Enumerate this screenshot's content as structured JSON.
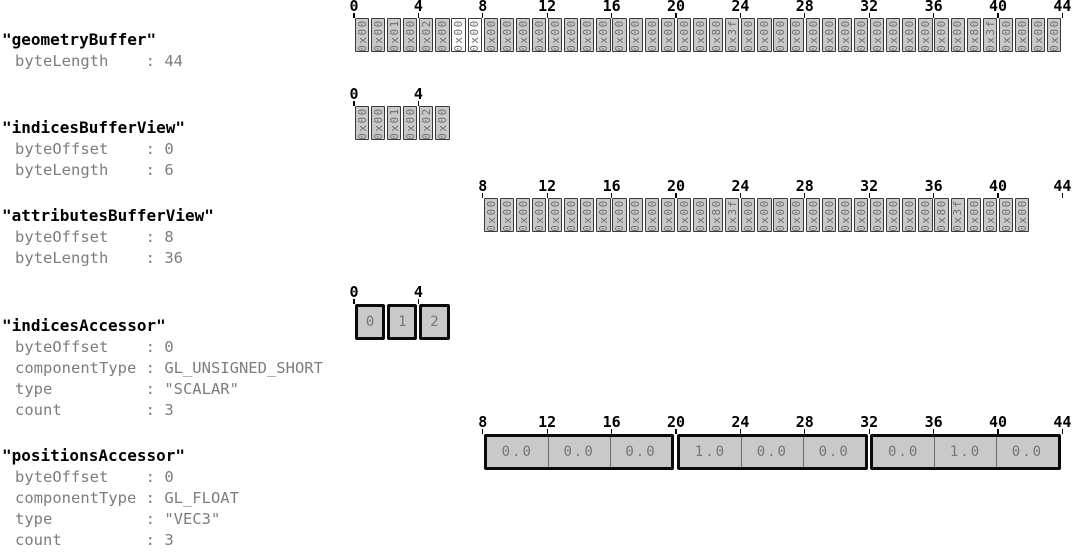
{
  "diagram": {
    "colors": {
      "cell_fill": "#c9c9c9",
      "highlight_cell_fill": "#fbfbfb",
      "cell_border": "#3a3a3a",
      "accessor_border": "#0a0a0a",
      "muted_text": "#7d7d7d",
      "title_text": "#000000"
    },
    "sections": [
      {
        "title": "\"geometryBuffer\"",
        "properties": [
          {
            "key": "byteLength",
            "value": "44"
          }
        ],
        "row": {
          "kind": "bytes",
          "start_byte": 0,
          "ticks": [
            0,
            4,
            8,
            12,
            16,
            20,
            24,
            28,
            32,
            36,
            40,
            44
          ],
          "cells": [
            "0x00",
            "0x00",
            "0x01",
            "0x00",
            "0x02",
            "0x00",
            "0x00",
            "0x00",
            "0x00",
            "0x00",
            "0x00",
            "0x00",
            "0x00",
            "0x00",
            "0x00",
            "0x00",
            "0x00",
            "0x00",
            "0x00",
            "0x00",
            "0x00",
            "0x00",
            "0x80",
            "0x3f",
            "0x00",
            "0x00",
            "0x00",
            "0x00",
            "0x00",
            "0x00",
            "0x00",
            "0x00",
            "0x00",
            "0x00",
            "0x00",
            "0x00",
            "0x00",
            "0x00",
            "0x80",
            "0x3f",
            "0x00",
            "0x00",
            "0x00",
            "0x00"
          ],
          "white_cells": [
            6,
            7
          ]
        }
      },
      {
        "title": "\"indicesBufferView\"",
        "properties": [
          {
            "key": "byteOffset",
            "value": "0"
          },
          {
            "key": "byteLength",
            "value": "6"
          }
        ],
        "row": {
          "kind": "bytes",
          "start_byte": 0,
          "ticks": [
            0,
            4
          ],
          "cells": [
            "0x00",
            "0x00",
            "0x01",
            "0x00",
            "0x02",
            "0x00"
          ],
          "white_cells": []
        }
      },
      {
        "title": "\"attributesBufferView\"",
        "properties": [
          {
            "key": "byteOffset",
            "value": "8"
          },
          {
            "key": "byteLength",
            "value": "36"
          }
        ],
        "row": {
          "kind": "bytes",
          "start_byte": 8,
          "ticks": [
            8,
            12,
            16,
            20,
            24,
            28,
            32,
            36,
            40,
            44
          ],
          "cells": [
            "0x00",
            "0x00",
            "0x00",
            "0x00",
            "0x00",
            "0x00",
            "0x00",
            "0x00",
            "0x00",
            "0x00",
            "0x00",
            "0x00",
            "0x00",
            "0x00",
            "0x80",
            "0x3f",
            "0x00",
            "0x00",
            "0x00",
            "0x00",
            "0x00",
            "0x00",
            "0x00",
            "0x00",
            "0x00",
            "0x00",
            "0x00",
            "0x00",
            "0x80",
            "0x3f",
            "0x00",
            "0x00",
            "0x00",
            "0x00"
          ],
          "white_cells": []
        }
      },
      {
        "title": "\"indicesAccessor\"",
        "properties": [
          {
            "key": "byteOffset",
            "value": "0"
          },
          {
            "key": "componentType",
            "value": "GL_UNSIGNED_SHORT"
          },
          {
            "key": "type",
            "value": "\"SCALAR\""
          },
          {
            "key": "count",
            "value": "3"
          }
        ],
        "row": {
          "kind": "index_cells",
          "start_byte": 0,
          "byte_span": 2,
          "ticks": [
            0,
            4
          ],
          "values": [
            "0",
            "1",
            "2"
          ]
        }
      },
      {
        "title": "\"positionsAccessor\"",
        "properties": [
          {
            "key": "byteOffset",
            "value": "0"
          },
          {
            "key": "componentType",
            "value": "GL_FLOAT"
          },
          {
            "key": "type",
            "value": "\"VEC3\""
          },
          {
            "key": "count",
            "value": "3"
          }
        ],
        "row": {
          "kind": "vector_groups",
          "start_byte": 8,
          "byte_span": 4,
          "ticks": [
            8,
            12,
            16,
            20,
            24,
            28,
            32,
            36,
            40,
            44
          ],
          "groups": [
            [
              "0.0",
              "0.0",
              "0.0"
            ],
            [
              "1.0",
              "0.0",
              "0.0"
            ],
            [
              "0.0",
              "1.0",
              "0.0"
            ]
          ]
        }
      }
    ]
  }
}
